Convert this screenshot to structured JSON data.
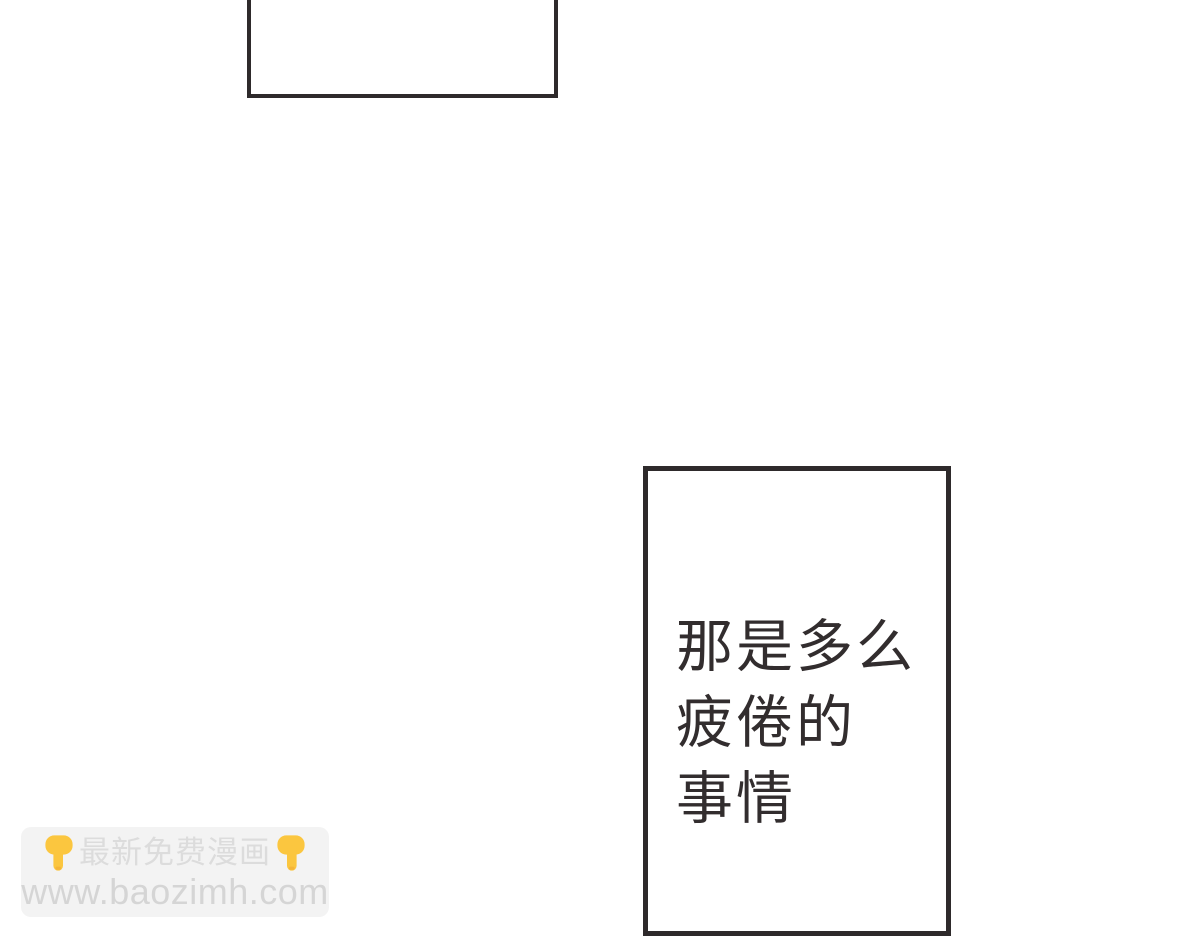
{
  "page": {
    "background_color": "#ffffff"
  },
  "panels": {
    "top_speech_box": {
      "text": "",
      "note": "empty speech box cropped at top edge"
    },
    "main_speech_box": {
      "lines": [
        "那是多么",
        "疲倦的",
        "事情"
      ],
      "full_text": "那是多么疲倦的事情"
    }
  },
  "watermark": {
    "title": "最新免费漫画",
    "url": "www.baozimh.com",
    "hand_icon": "backhand-index-pointing-down"
  },
  "colors": {
    "panel_border": "#2e2a2b",
    "speech_text": "#322d2e",
    "watermark_bg": "#f3f3f3",
    "watermark_text": "#dcdcdc",
    "watermark_url": "#d5d5d5",
    "hand_yellow": "#fbc63f",
    "hand_shade": "#f0a833"
  }
}
